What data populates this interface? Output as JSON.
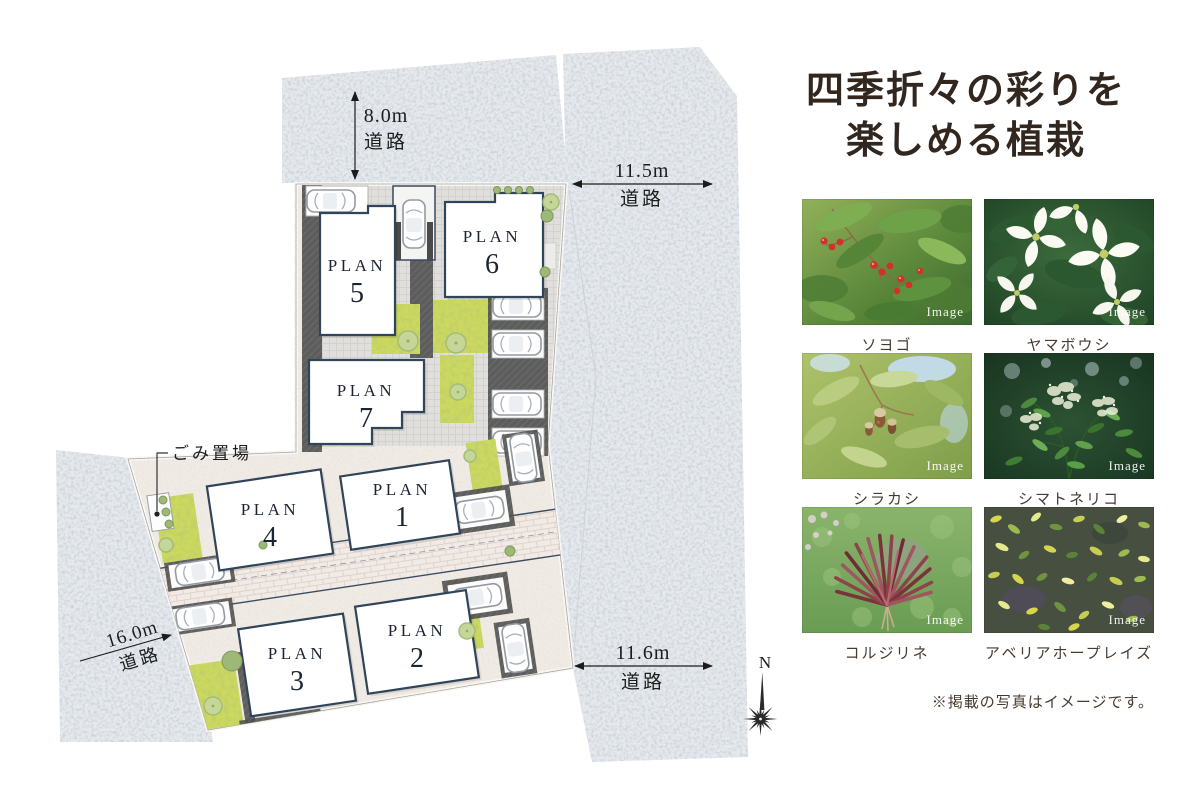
{
  "site_plan": {
    "dimensions": {
      "top": {
        "value": "8.0m",
        "unit_label": "道路"
      },
      "right_upper": {
        "value": "11.5m",
        "unit_label": "道路"
      },
      "left": {
        "value": "16.0m",
        "unit_label": "道路"
      },
      "right_lower": {
        "value": "11.6m",
        "unit_label": "道路"
      }
    },
    "plots": [
      {
        "label": "PLAN",
        "number": "1"
      },
      {
        "label": "PLAN",
        "number": "2"
      },
      {
        "label": "PLAN",
        "number": "3"
      },
      {
        "label": "PLAN",
        "number": "4"
      },
      {
        "label": "PLAN",
        "number": "5"
      },
      {
        "label": "PLAN",
        "number": "6"
      },
      {
        "label": "PLAN",
        "number": "7"
      }
    ],
    "garbage_area_label": "ごみ置場",
    "compass": {
      "north_label": "N"
    },
    "colors": {
      "road": "#e6eaee",
      "site_ground": "#f1ebe5",
      "lawn": "#ccd95e",
      "building_fill": "#ffffff",
      "building_outline": "#31455a",
      "label_text": "#1a2433"
    }
  },
  "plants_panel": {
    "title_lines": [
      "四季折々の彩りを",
      "楽しめる植栽"
    ],
    "title_color": "#32271f",
    "items": [
      {
        "name": "ソヨゴ",
        "watermark": "Image"
      },
      {
        "name": "ヤマボウシ",
        "watermark": "Image"
      },
      {
        "name": "シラカシ",
        "watermark": "Image"
      },
      {
        "name": "シマトネリコ",
        "watermark": "Image"
      },
      {
        "name": "コルジリネ",
        "watermark": "Image"
      },
      {
        "name": "アベリアホープレイズ",
        "watermark": "Image"
      }
    ],
    "note": "※掲載の写真はイメージです。"
  }
}
